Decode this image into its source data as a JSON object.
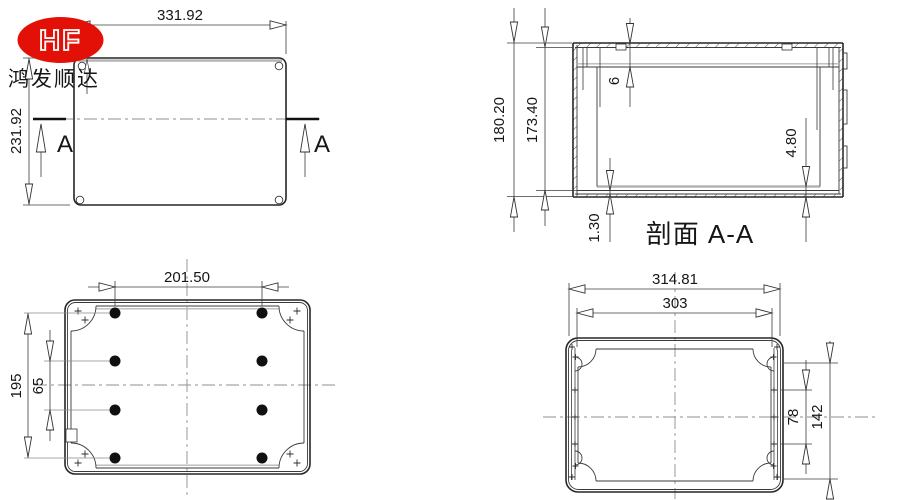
{
  "drawing": {
    "logo": {
      "brand": "HF",
      "company": "鸿发顺达"
    },
    "colors": {
      "accent_red": "#e31008",
      "line": "#2e2e2e",
      "gray_line": "#b3b3b3"
    },
    "top_view": {
      "width": "331.92",
      "height": "231.92",
      "section_marker_left": "A",
      "section_marker_right": "A"
    },
    "section_view": {
      "title": "剖面 A-A",
      "overall_height": "180.20",
      "internal_height": "173.40",
      "lid_thickness": "6",
      "base_thickness": "4.80",
      "rib_step": "1.30"
    },
    "lid_inner_view": {
      "hole_spacing_h": "201.50",
      "hole_spacing_v": "195",
      "hole_spacing_inner": "65"
    },
    "base_inner_view": {
      "overall_width": "314.81",
      "hole_spacing_h": "303",
      "screw_spacing_inner": "78",
      "screw_spacing_outer": "142"
    }
  }
}
